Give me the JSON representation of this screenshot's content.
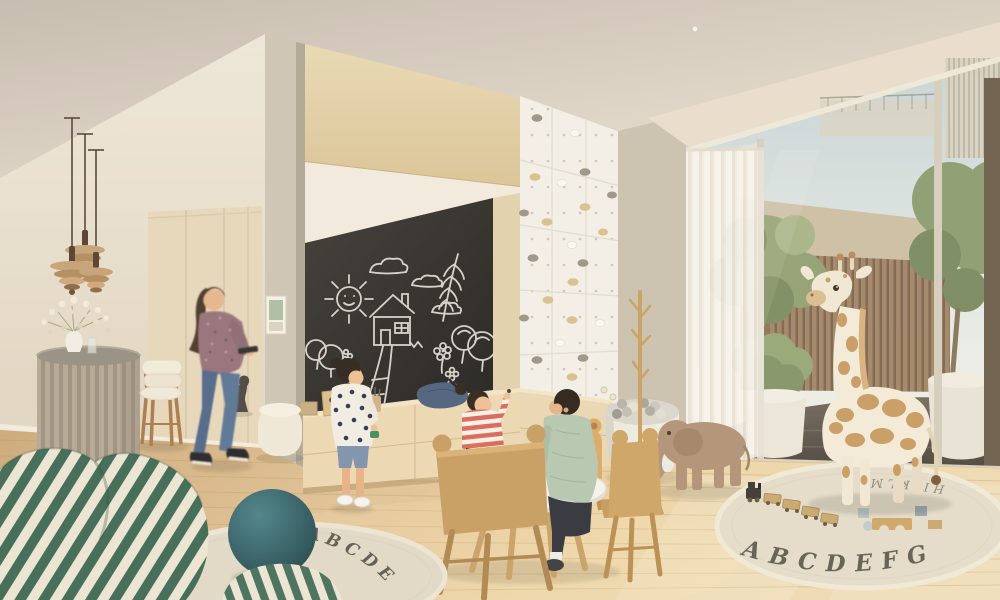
{
  "scene": {
    "type": "children-playroom-interior-rendering",
    "left_rug_letters": "ABCDE",
    "right_rug_letters_front": "ABCDEFG",
    "right_rug_letters_back": "HIJKLM"
  },
  "palette": {
    "ceiling": "#d9d0c4",
    "wall": "#eae2d2",
    "wood_panel": "#e2d0a9",
    "chalkboard": "#2e2c29",
    "chalk": "#eceae2",
    "floor": "#e3c697",
    "climbing_wall": "#f4f1ea",
    "curtain": "#f6f3ec",
    "fence_slats": "#a28768",
    "foliage": "#8b9a6e",
    "giraffe_body": "#f4ecdb",
    "giraffe_spots": "#c6975c",
    "stripe_green": "#3f6a56",
    "teal_ball": "#2c565c",
    "denim": "#5d7795",
    "sage_shirt": "#b6c8b1",
    "stripe_red": "#d9695b",
    "kids_wood": "#c89f62"
  },
  "objects": [
    "pendant-lamp",
    "flower-counter",
    "bar-stool",
    "woman-walking",
    "wood-dog-sculpture",
    "closet",
    "picture-frame",
    "chalkboard",
    "chalk-drawings",
    "toy-cabinet",
    "climbing-wall",
    "coat-rack",
    "ball-pit",
    "toy-elephant",
    "kids-table",
    "tea-set",
    "animal-ear-chairs",
    "girl-standing",
    "girl-sitting",
    "boy-sitting",
    "plush-giraffe",
    "window-wall",
    "sheer-curtain",
    "olive-trees",
    "alphabet-rug-left",
    "alphabet-rug-right",
    "toy-train",
    "wood-blocks",
    "striped-bean-chair",
    "striped-pouf",
    "teal-ball"
  ]
}
